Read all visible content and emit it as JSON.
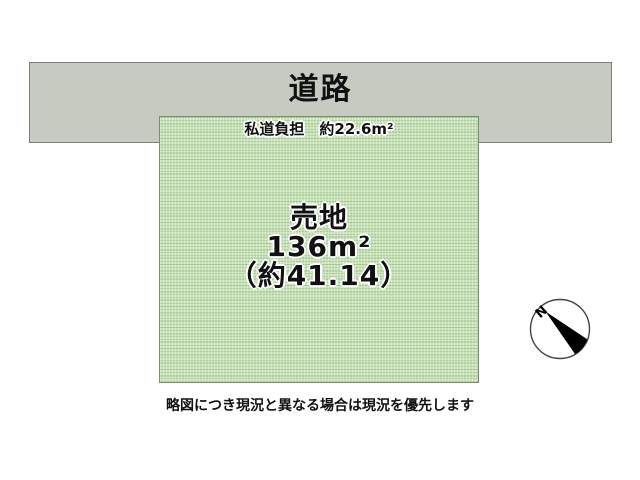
{
  "road": {
    "label": "道路",
    "fill_color": "#c6cbc2",
    "border_color": "#7d807a"
  },
  "plot": {
    "private_road_label": "私道負担　約22.6m²",
    "center": {
      "title": "売地",
      "area_sqm": "136m²",
      "area_tsubo": "（約41.14）"
    },
    "fill_color": "#c8e3b9",
    "border_color": "#7f8b72"
  },
  "compass": {
    "north_label": "N"
  },
  "caption": {
    "text": "略図につき現況と異なる場合は現況を優先します"
  }
}
